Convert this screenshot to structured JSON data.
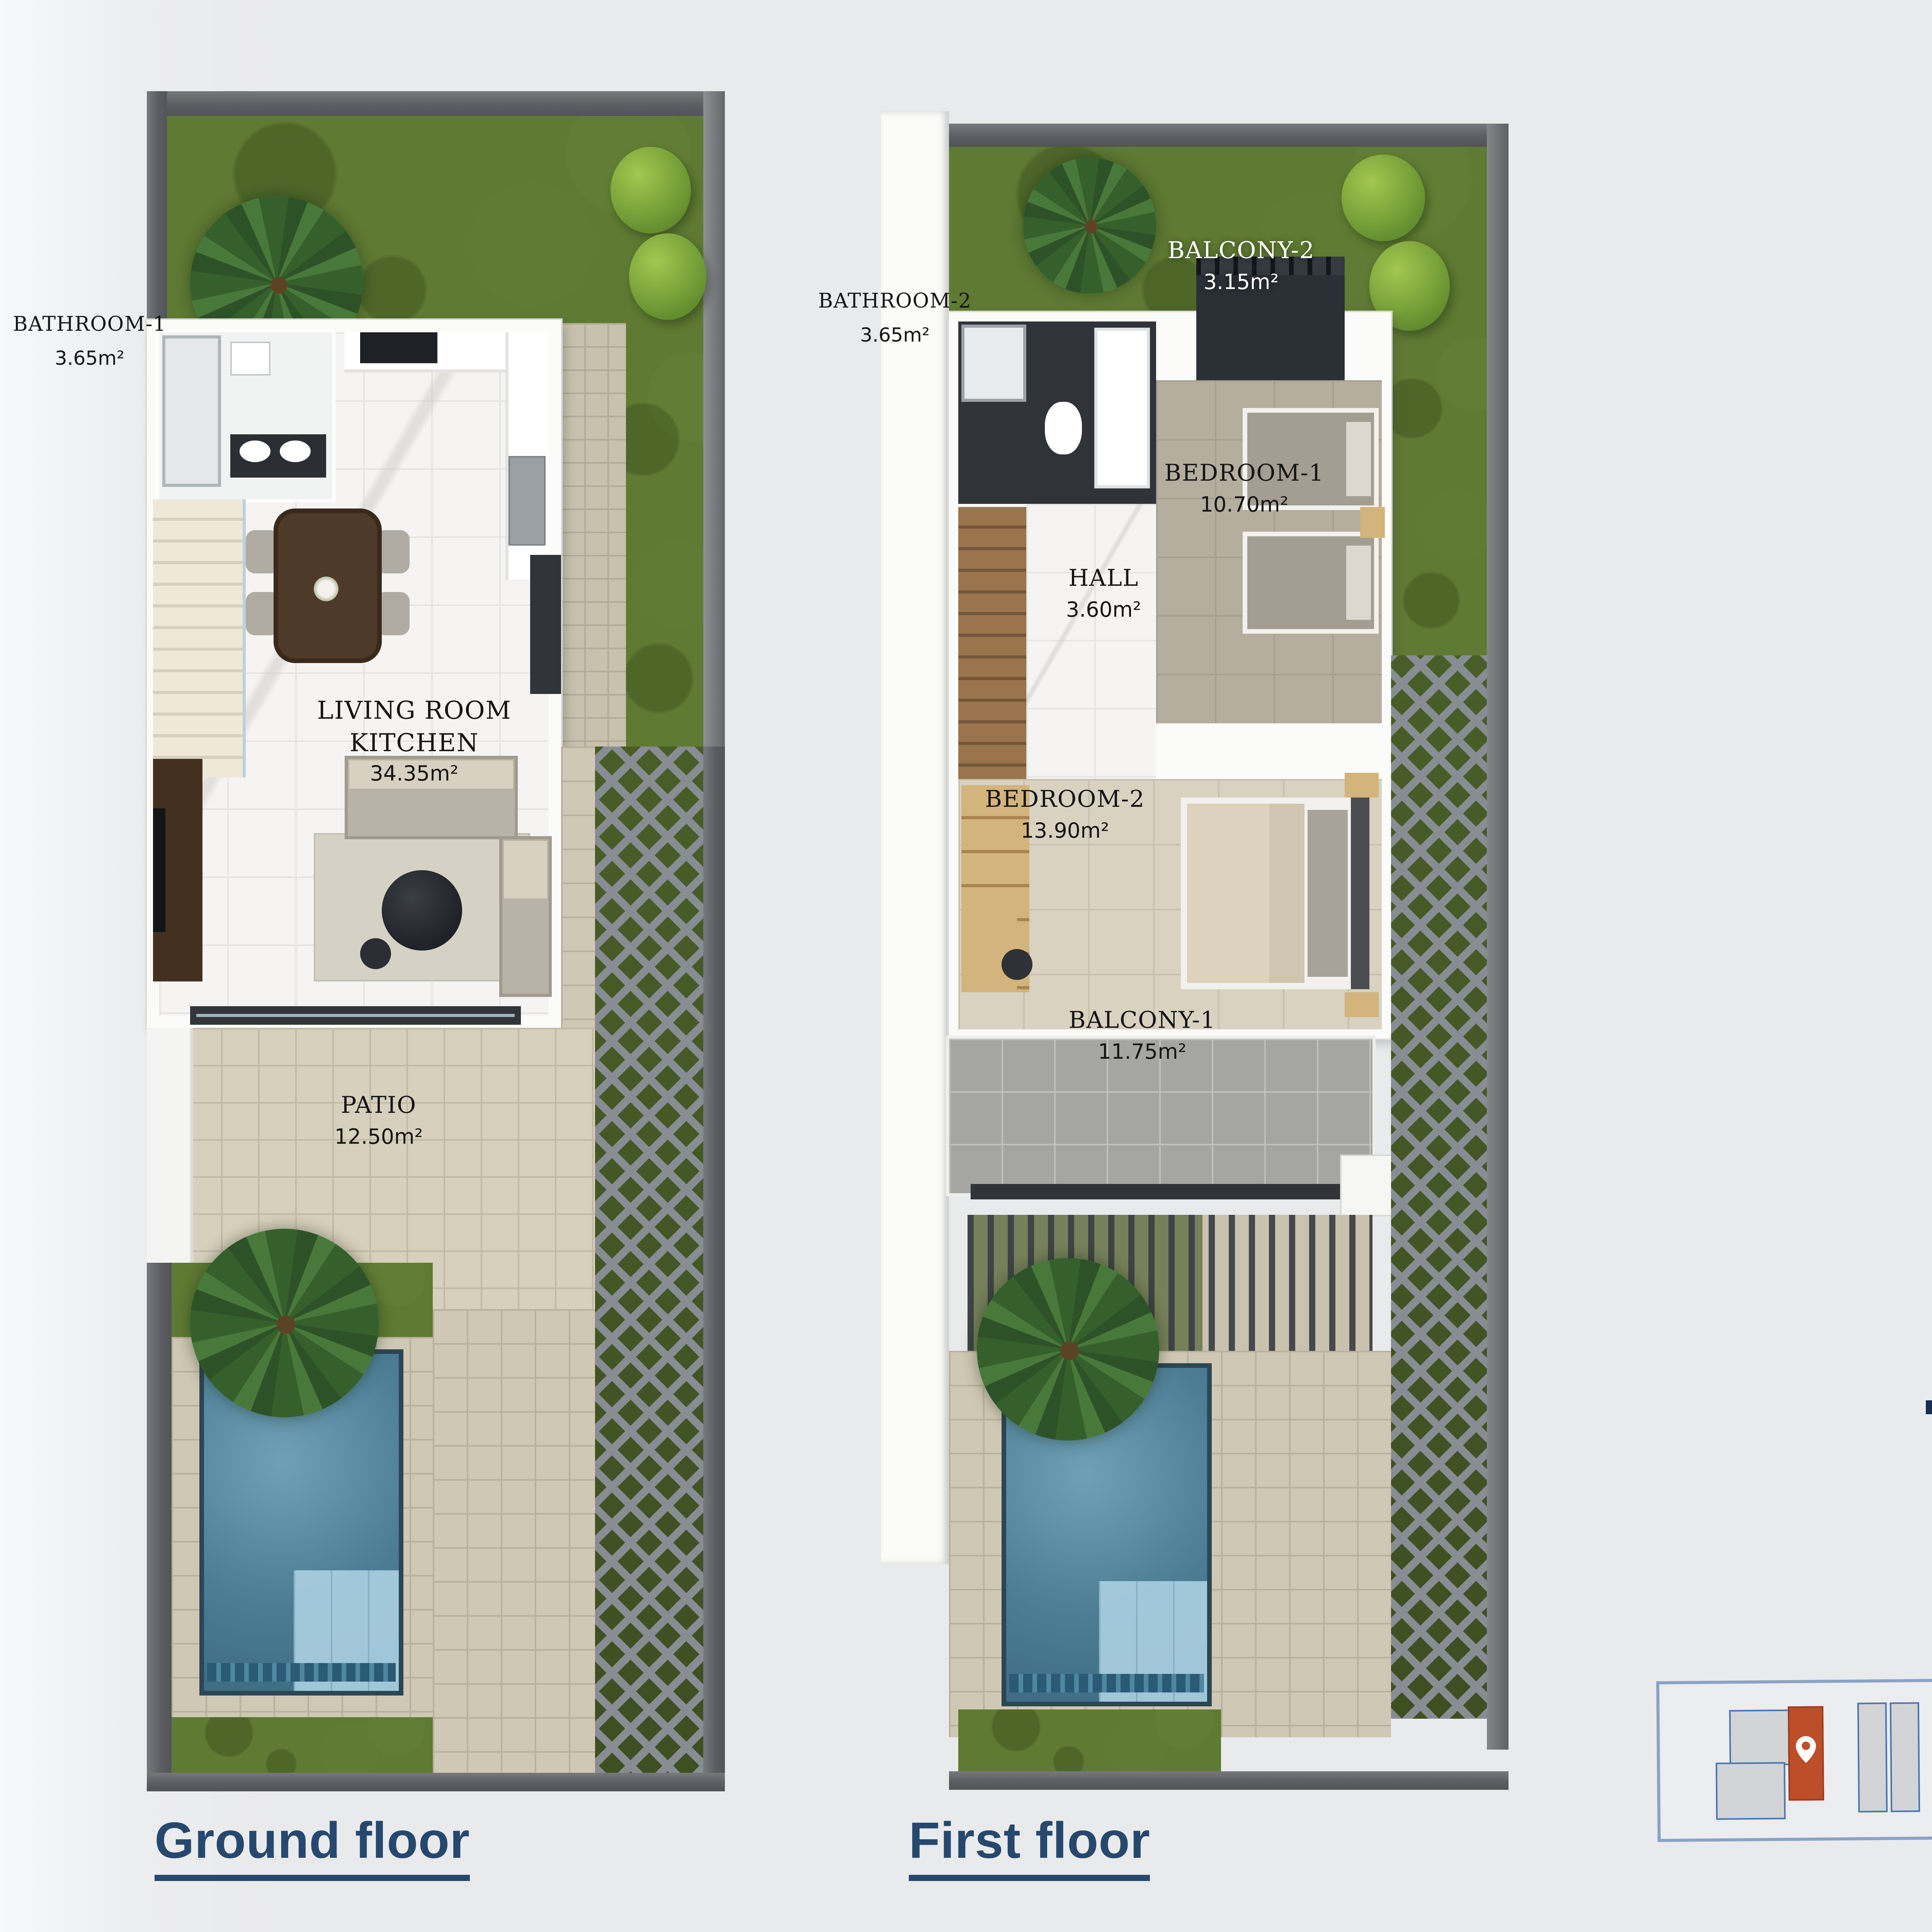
{
  "info_panel": {
    "title": "VILLA 3",
    "bathrooms_count": "2",
    "bedrooms_count": "2",
    "area": "86,1 sqm",
    "plot": "plot: 185 sqm"
  },
  "floors": {
    "ground": {
      "label": "Ground floor",
      "rooms": {
        "bathroom1": {
          "name": "BATHROOM-1",
          "area": "3.65m²"
        },
        "living": {
          "line1": "LIVING ROOM",
          "line2": "KITCHEN",
          "area": "34.35m²"
        },
        "patio": {
          "name": "PATIO",
          "area": "12.50m²"
        }
      }
    },
    "first": {
      "label": "First floor",
      "rooms": {
        "bathroom2": {
          "name": "BATHROOM-2",
          "area": "3.65m²"
        },
        "balcony2": {
          "name": "BALCONY-2",
          "area": "3.15m²"
        },
        "bedroom1": {
          "name": "BEDROOM-1",
          "area": "10.70m²"
        },
        "hall": {
          "name": "HALL",
          "area": "3.60m²"
        },
        "bedroom2": {
          "name": "BEDROOM-2",
          "area": "13.90m²"
        },
        "balcony1": {
          "name": "BALCONY-1",
          "area": "11.75m²"
        }
      }
    }
  },
  "colors": {
    "accent_navy": "#1b2c52",
    "heading_blue": "#27486e",
    "highlight_orange": "#bd4e2a"
  }
}
